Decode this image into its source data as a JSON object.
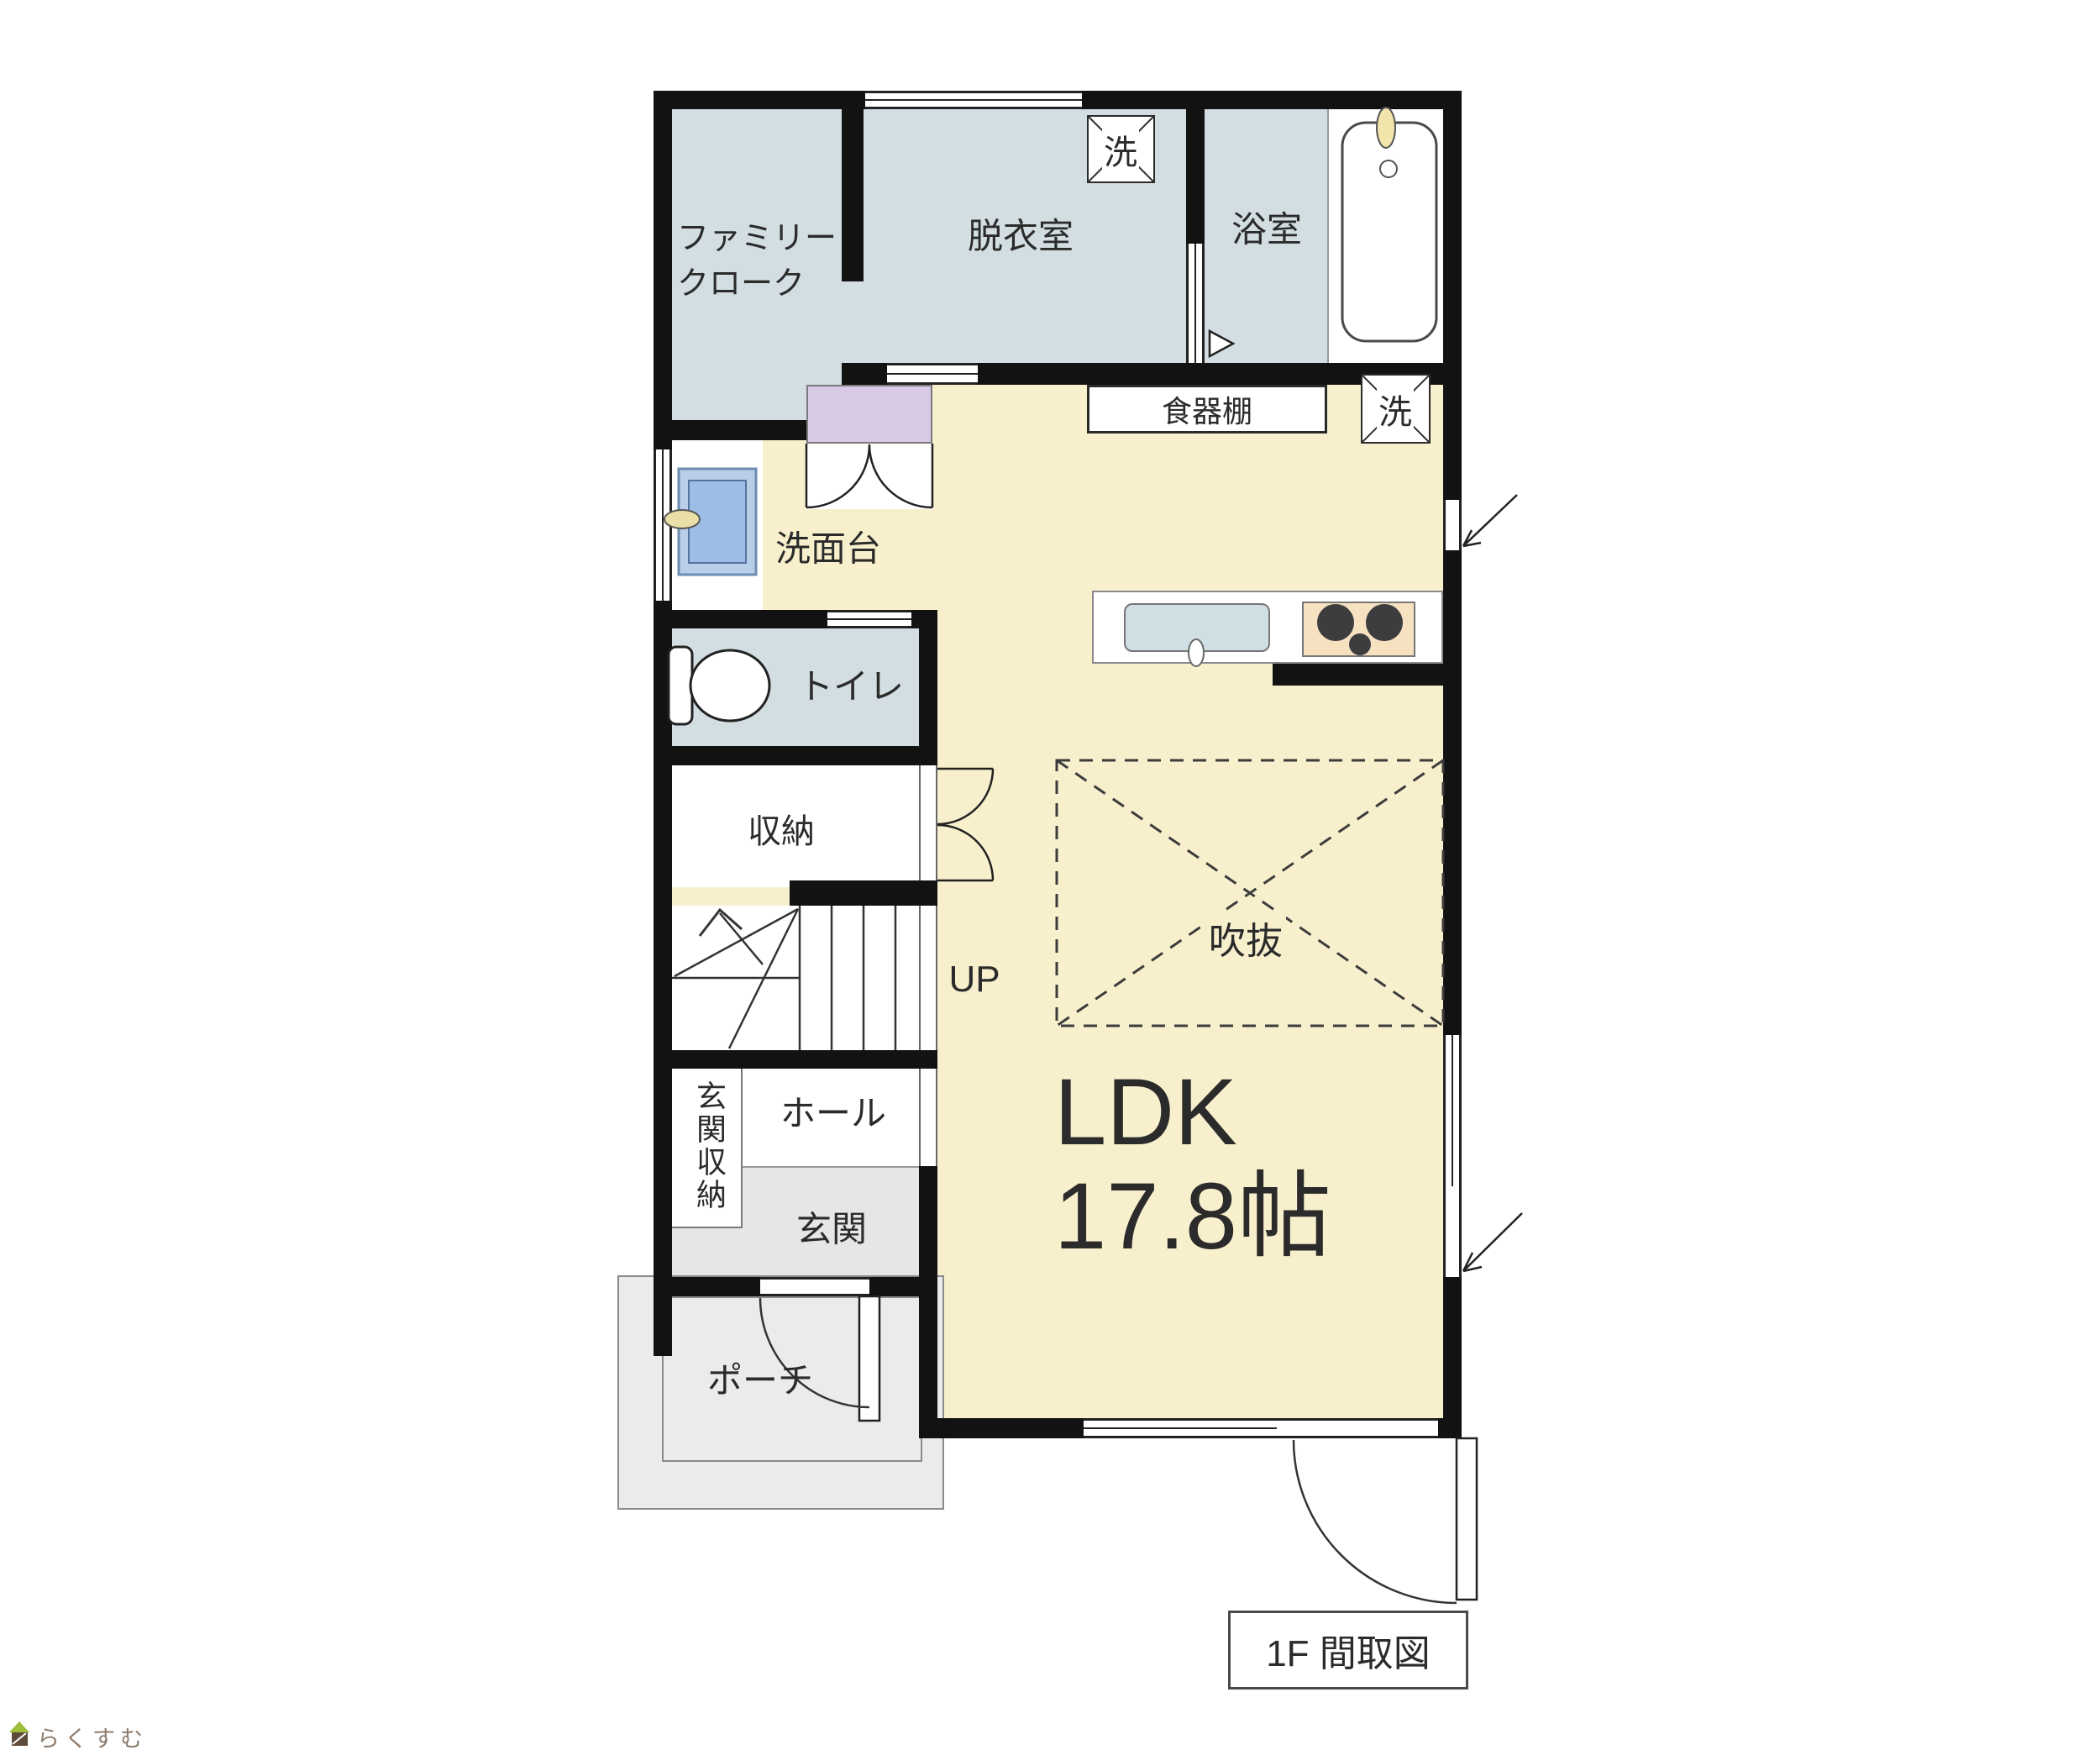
{
  "title": "1F floor plan (Japanese real-estate madorizu)",
  "labels": {
    "family_closet_line1": "ファミリー",
    "family_closet_line2": "クローク",
    "dressing_room": "脱衣室",
    "bathroom": "浴室",
    "washing_machine": "洗",
    "dish_cabinet": "食器棚",
    "washstand": "洗面台",
    "toilet": "トイレ",
    "storage": "収納",
    "stairs_up": "UP",
    "entrance_storage": "玄関収納",
    "hall": "ホール",
    "entrance": "玄関",
    "porch": "ポーチ",
    "void_atrium": "吹抜",
    "ldk_name": "LDK",
    "ldk_size": "17.8帖",
    "caption": "1F 間取図",
    "watermark": "らくすむ"
  },
  "colors": {
    "wall": "#121212",
    "wet_room_floor": "#d3dee3",
    "ldk_floor": "#f8f0cd",
    "entrance_floor": "#e5e6e8",
    "porch_floor": "#ebebed",
    "cabinet_purple": "#d8c9e4",
    "washbasin_blue": "#9dbde7",
    "sink_blue": "#cfdfe4",
    "stove_tan": "#f6e2c0",
    "watermark_text": "#8d7b6c",
    "watermark_roof_green": "#9fbf3b",
    "watermark_body_brown": "#5f4b3a"
  }
}
